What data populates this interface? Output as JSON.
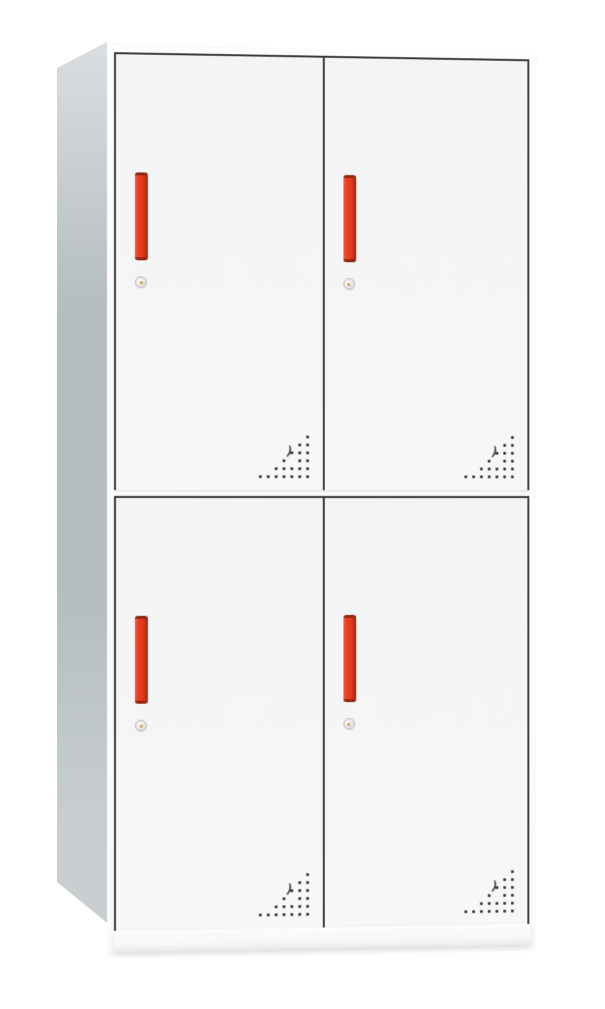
{
  "scene": {
    "description": "Product photo of a white four-door steel locker cabinet with red vertical handles, round cam locks and triangular ventilation perforations",
    "background": "#ffffff"
  },
  "colors": {
    "frame": "#3a3b3c",
    "side_light": "#dadee1",
    "side_mid": "#b5bdc0",
    "side_low": "#c9cfd0",
    "handle_light": "#f05a38",
    "handle_main": "#e63a1c",
    "handle_dark": "#a82508",
    "handle_cap": "#93270f",
    "lock_body": "#eceae4",
    "lock_edge": "#b9b8b0",
    "lock_center": "#c79b4e",
    "vent_dot": "#3b3b3b"
  },
  "cabinet": {
    "door_count": 4,
    "handle_style": "vertical-bar",
    "lock_style": "round-cam-lock",
    "units": [
      {
        "id": "upper",
        "doors": [
          {
            "id": "top-left"
          },
          {
            "id": "top-right"
          }
        ]
      },
      {
        "id": "lower",
        "doors": [
          {
            "id": "bottom-left"
          },
          {
            "id": "bottom-right"
          }
        ]
      }
    ]
  },
  "vent_pattern": {
    "cols": 7,
    "spacing_px": 8,
    "dot_px": 2.6,
    "rows": [
      [
        6
      ],
      [
        5,
        6
      ],
      [
        4,
        5,
        6
      ],
      [
        3,
        5,
        6
      ],
      [
        2,
        3,
        4,
        5,
        6
      ],
      [
        0,
        1,
        2,
        3,
        4,
        5,
        6
      ]
    ],
    "crescent": {
      "left_px": 27,
      "top_px": 10,
      "glyph": ")"
    }
  }
}
